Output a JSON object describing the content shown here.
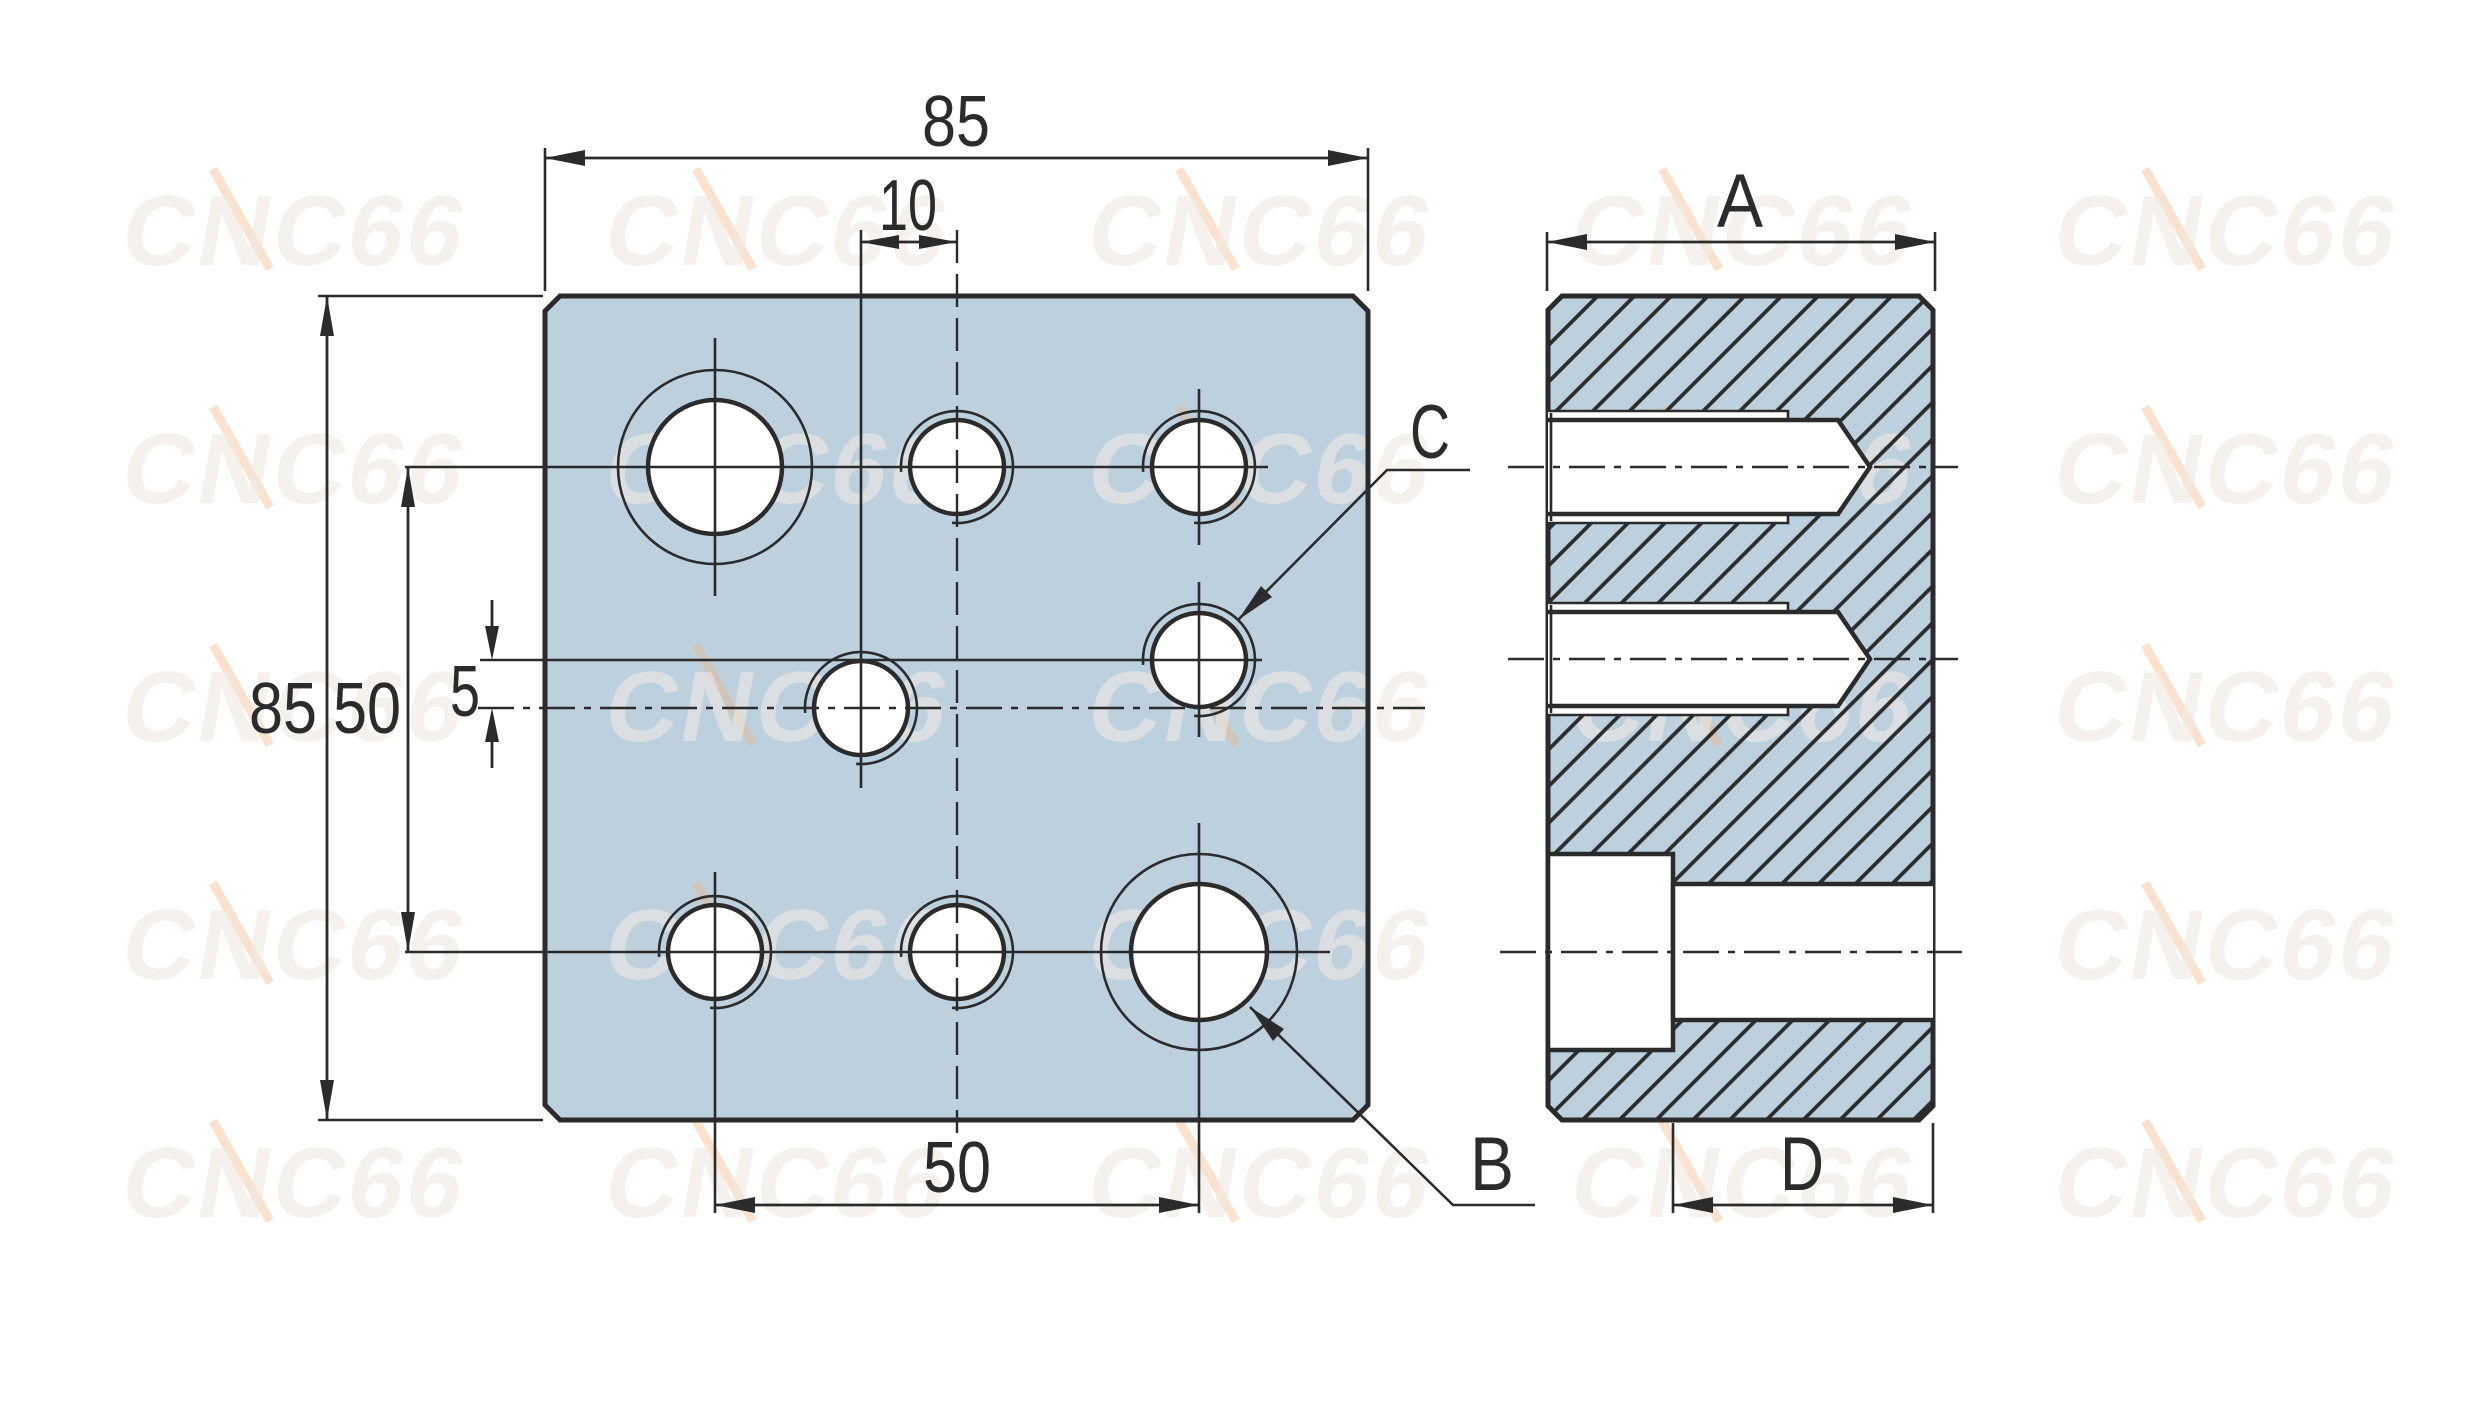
{
  "watermark": {
    "text": "CNC66",
    "color": "#efe9e2",
    "accent_color": "#f2b47e"
  },
  "colors": {
    "background": "#ffffff",
    "plate_fill": "#bdd0de",
    "line": "#2b2b2b"
  },
  "front_view": {
    "dim_width_top": "85",
    "dim_center_offset": "10",
    "dim_height_left": "85",
    "dim_row_span_left": "50",
    "dim_row_offset": "5",
    "dim_hole_span_bottom": "50",
    "label_hole_b": "B",
    "label_hole_c": "C"
  },
  "side_view": {
    "dim_width_top": "A",
    "dim_bore_length_bottom": "D"
  }
}
